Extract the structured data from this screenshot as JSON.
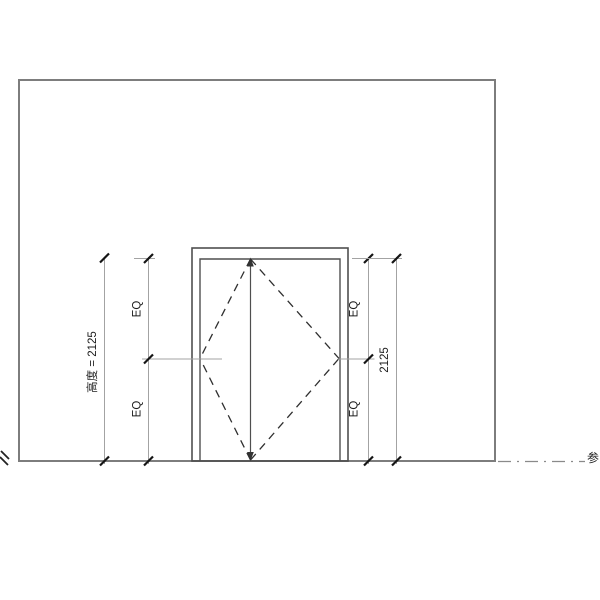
{
  "drawing": {
    "kind": "door-elevation"
  },
  "dims": {
    "left_overall": "高度 = 2125",
    "left_eq_upper": "EQ",
    "left_eq_lower": "EQ",
    "right_eq_upper": "EQ",
    "right_eq_lower": "EQ",
    "right_overall": "2125"
  },
  "level": {
    "label": "参"
  },
  "colors": {
    "background": "#ffffff",
    "wall_line": "#7d7d7d",
    "door_line": "#4f4f4f",
    "dashed_swing": "#2f2f2f",
    "dim_line": "#a3a3a3",
    "tick": "#151515",
    "text": "#1c1c1c",
    "level_line": "#8a8a8a"
  }
}
